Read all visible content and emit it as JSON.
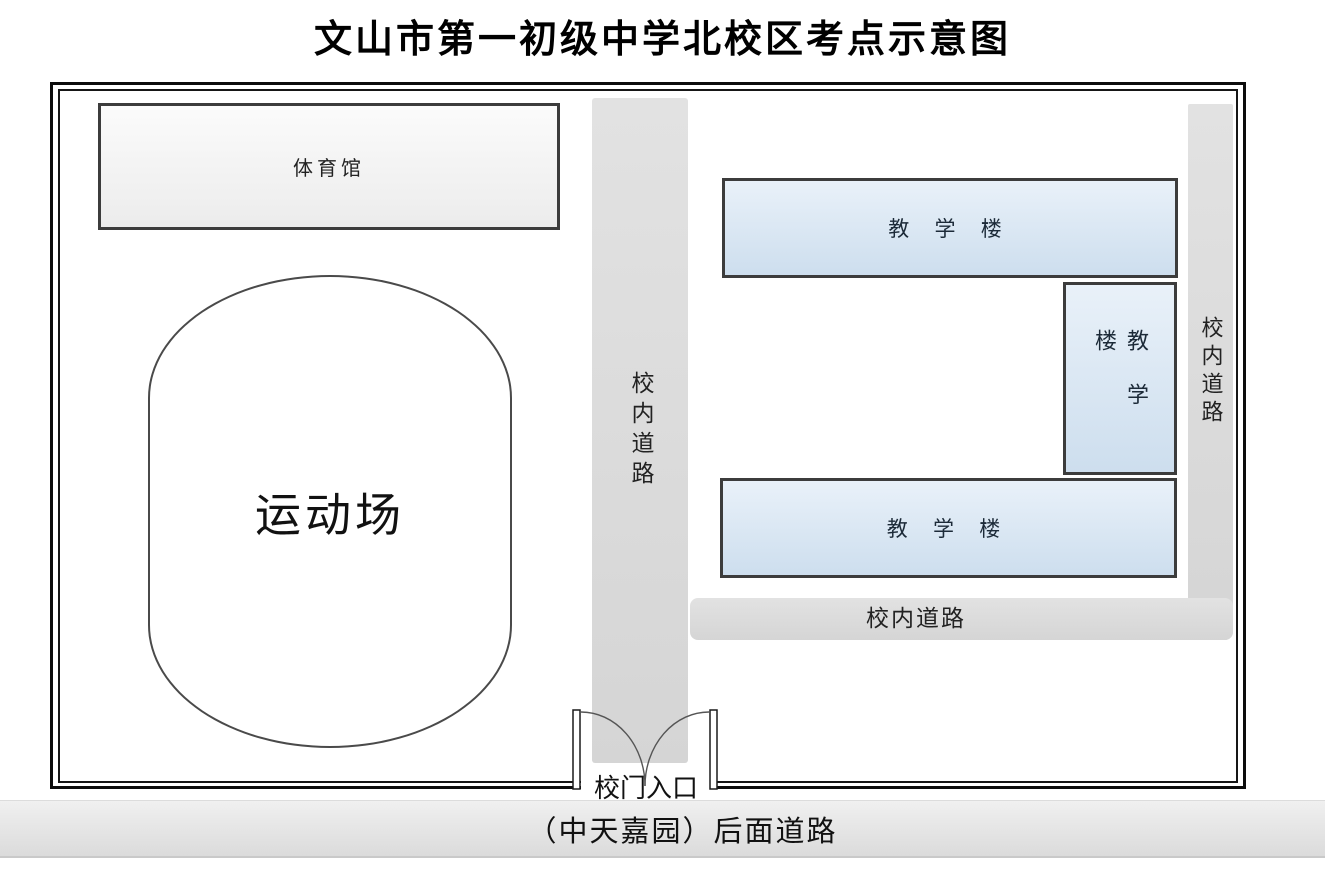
{
  "title": "文山市第一初级中学北校区考点示意图",
  "map": {
    "gym_label": "体育馆",
    "field_label": "运动场",
    "center_road_label": "校内道路",
    "right_road_label": "校内道路",
    "bottom_road_label": "校内道路",
    "building_top_label": "教 学 楼",
    "building_right_label": "教学楼",
    "building_bottom_label": "教 学 楼",
    "gate_label": "校门入口",
    "street_label": "（中天嘉园）后面道路"
  },
  "colors": {
    "building_border": "#3c3c3c",
    "building_fill_top": "#e9f1f9",
    "building_fill_bottom": "#cddeee",
    "gym_fill_top": "#fbfbfb",
    "gym_fill_bottom": "#ececec",
    "road_fill_light": "#e2e2e2",
    "road_fill_dark": "#d5d5d5",
    "street_fill_top": "#f0f0f0",
    "street_fill_bottom": "#dbdbdb"
  }
}
